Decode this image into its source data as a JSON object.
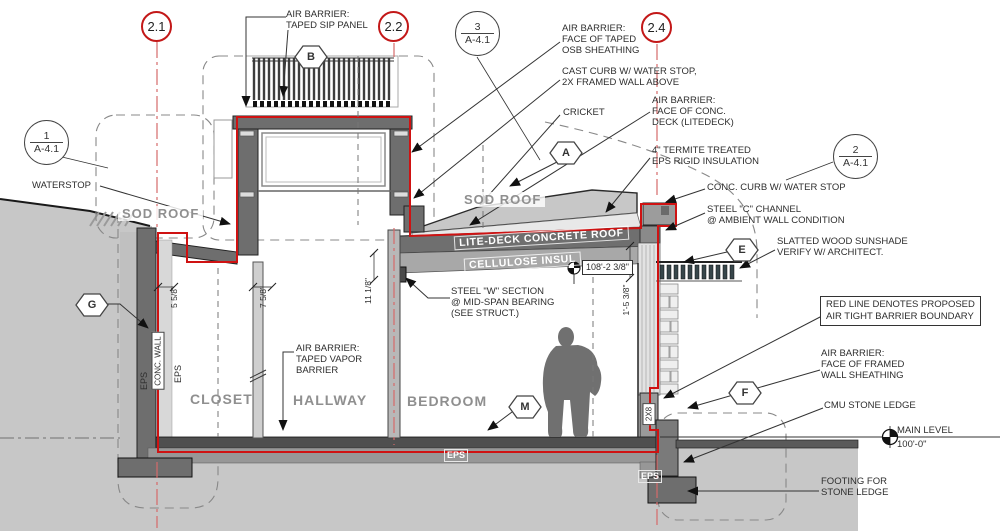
{
  "colors": {
    "barrier_red": "#cf1212",
    "grid_red": "#c31818",
    "structure_gray": "#6e6e6e",
    "earth_gray": "#c7c7c7",
    "text_dark": "#2e2e2e",
    "room_label_gray": "#8f8f8f"
  },
  "grid": {
    "g21": "2.1",
    "g22": "2.2",
    "g24": "2.4"
  },
  "refs": {
    "r1": {
      "num": "1",
      "sheet": "A-4.1"
    },
    "r2": {
      "num": "2",
      "sheet": "A-4.1"
    },
    "r3": {
      "num": "3",
      "sheet": "A-4.1"
    }
  },
  "hex": {
    "a": "A",
    "b": "B",
    "e": "E",
    "f": "F",
    "g": "G",
    "m": "M"
  },
  "callouts": {
    "sip": {
      "l1": "AIR BARRIER:",
      "l2": "TAPED SIP PANEL"
    },
    "osb": {
      "l1": "AIR BARRIER:",
      "l2": "FACE OF TAPED",
      "l3": "OSB SHEATHING"
    },
    "cast_curb": {
      "l1": "CAST CURB W/ WATER STOP,",
      "l2": "2X FRAMED WALL ABOVE"
    },
    "cricket": {
      "l1": "CRICKET"
    },
    "conc_deck": {
      "l1": "AIR BARRIER:",
      "l2": "FACE OF CONC.",
      "l3": "DECK (LITEDECK)"
    },
    "termite": {
      "l1": "4\" TERMITE TREATED",
      "l2": "EPS RIGID INSULATION"
    },
    "conc_curb": {
      "l1": "CONC. CURB W/ WATER STOP"
    },
    "c_channel": {
      "l1": "STEEL \"C\" CHANNEL",
      "l2": "@ AMBIENT WALL CONDITION"
    },
    "sunshade": {
      "l1": "SLATTED WOOD SUNSHADE",
      "l2": "VERIFY W/ ARCHITECT."
    },
    "red_note": {
      "l1": "RED LINE DENOTES PROPOSED",
      "l2": "AIR TIGHT BARRIER BOUNDARY"
    },
    "framed_wall": {
      "l1": "AIR BARRIER:",
      "l2": "FACE OF FRAMED",
      "l3": "WALL SHEATHING"
    },
    "cmu": {
      "l1": "CMU STONE LEDGE"
    },
    "footing": {
      "l1": "FOOTING FOR",
      "l2": "STONE LEDGE"
    },
    "waterstop": {
      "l1": "WATERSTOP"
    },
    "steel_w": {
      "l1": "STEEL \"W\" SECTION",
      "l2": "@ MID-SPAN BEARING",
      "l3": "(SEE STRUCT.)"
    },
    "vapor": {
      "l1": "AIR BARRIER:",
      "l2": "TAPED VAPOR",
      "l3": "BARRIER"
    }
  },
  "rooms": {
    "closet": "CLOSET",
    "hallway": "HALLWAY",
    "bedroom": "BEDROOM"
  },
  "zones": {
    "sod_left": "SOD ROOF",
    "sod_mid": "SOD ROOF",
    "litedeck": "LITE-DECK CONCRETE ROOF",
    "cellulose": "CELLULOSE INSUL"
  },
  "tags": {
    "conc_wall": "CONC. WALL",
    "eps": "EPS",
    "two_by_eight": "2X8"
  },
  "dims": {
    "wall": "5 5/8\"",
    "partition": "7 5/8\"",
    "roof": "11 1/8\"",
    "parapet": "1'-5 3/8\"",
    "ceiling_elev": "108'-2 3/8\""
  },
  "levels": {
    "main": {
      "name": "MAIN LEVEL",
      "elev": "100'-0\""
    }
  }
}
